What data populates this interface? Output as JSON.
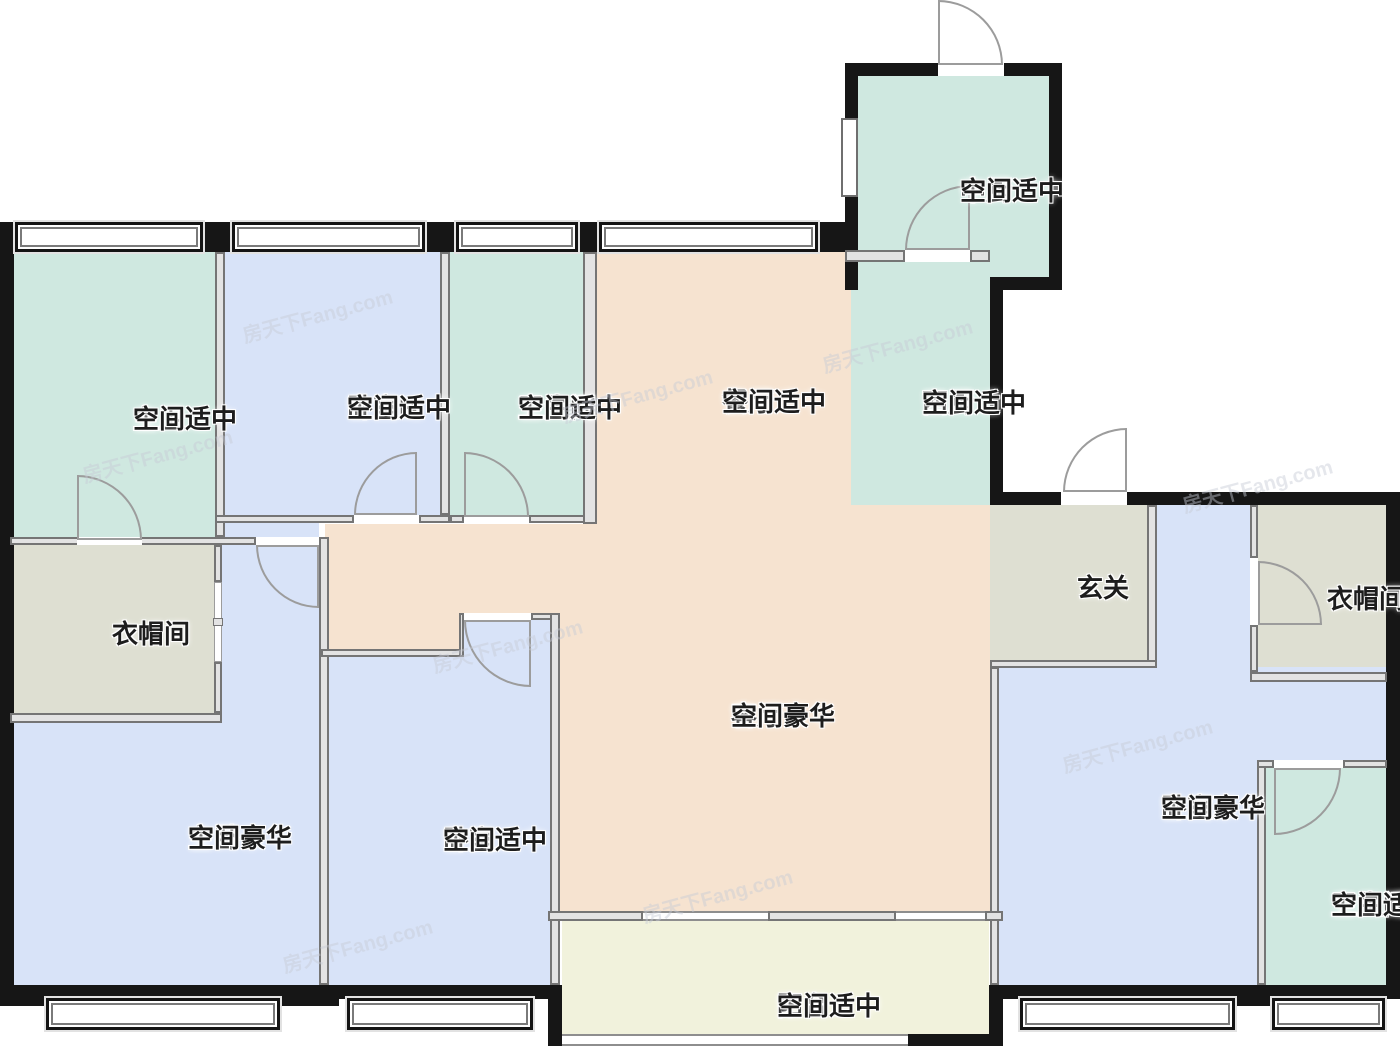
{
  "source_watermark": "房天下Fang.com",
  "palette": {
    "bedroom_blue": "#d8e3f8",
    "bath_kitchen_teal": "#cfe8e0",
    "hall_peach": "#f6e3d0",
    "cloak_grey": "#dedfd2",
    "balcony_cream": "#f1f2dc",
    "wall_black": "#161616"
  },
  "rooms": [
    {
      "key": "master-bath",
      "name": "主卫",
      "note": "空间适中"
    },
    {
      "key": "bedroom-b",
      "name": "卧室B",
      "note": "空间适中"
    },
    {
      "key": "bathroom",
      "name": "卫生间",
      "note": "空间适中"
    },
    {
      "key": "dining-room",
      "name": "餐厅",
      "note": "空间适中"
    },
    {
      "key": "chinese-kitchen",
      "name": "中厨",
      "note": "空间适中"
    },
    {
      "key": "western-kitchen",
      "name": "西厨",
      "note": "空间适中"
    },
    {
      "key": "entry-hall",
      "name": "玄关",
      "note": ""
    },
    {
      "key": "cloakroom",
      "name": "衣帽间",
      "note": ""
    },
    {
      "key": "cloakroom-a",
      "name": "衣帽间A",
      "note": ""
    },
    {
      "key": "master-bedroom",
      "name": "主卧",
      "note": "空间豪华"
    },
    {
      "key": "bedroom",
      "name": "卧室",
      "note": "空间适中"
    },
    {
      "key": "living-room",
      "name": "客厅",
      "note": "空间豪华"
    },
    {
      "key": "bedroom-a",
      "name": "卧室A",
      "note": "空间豪华"
    },
    {
      "key": "bathroom-a",
      "name": "卫生间A",
      "note": "空间适中"
    },
    {
      "key": "balcony",
      "name": "阳台",
      "note": "空间适中"
    }
  ]
}
